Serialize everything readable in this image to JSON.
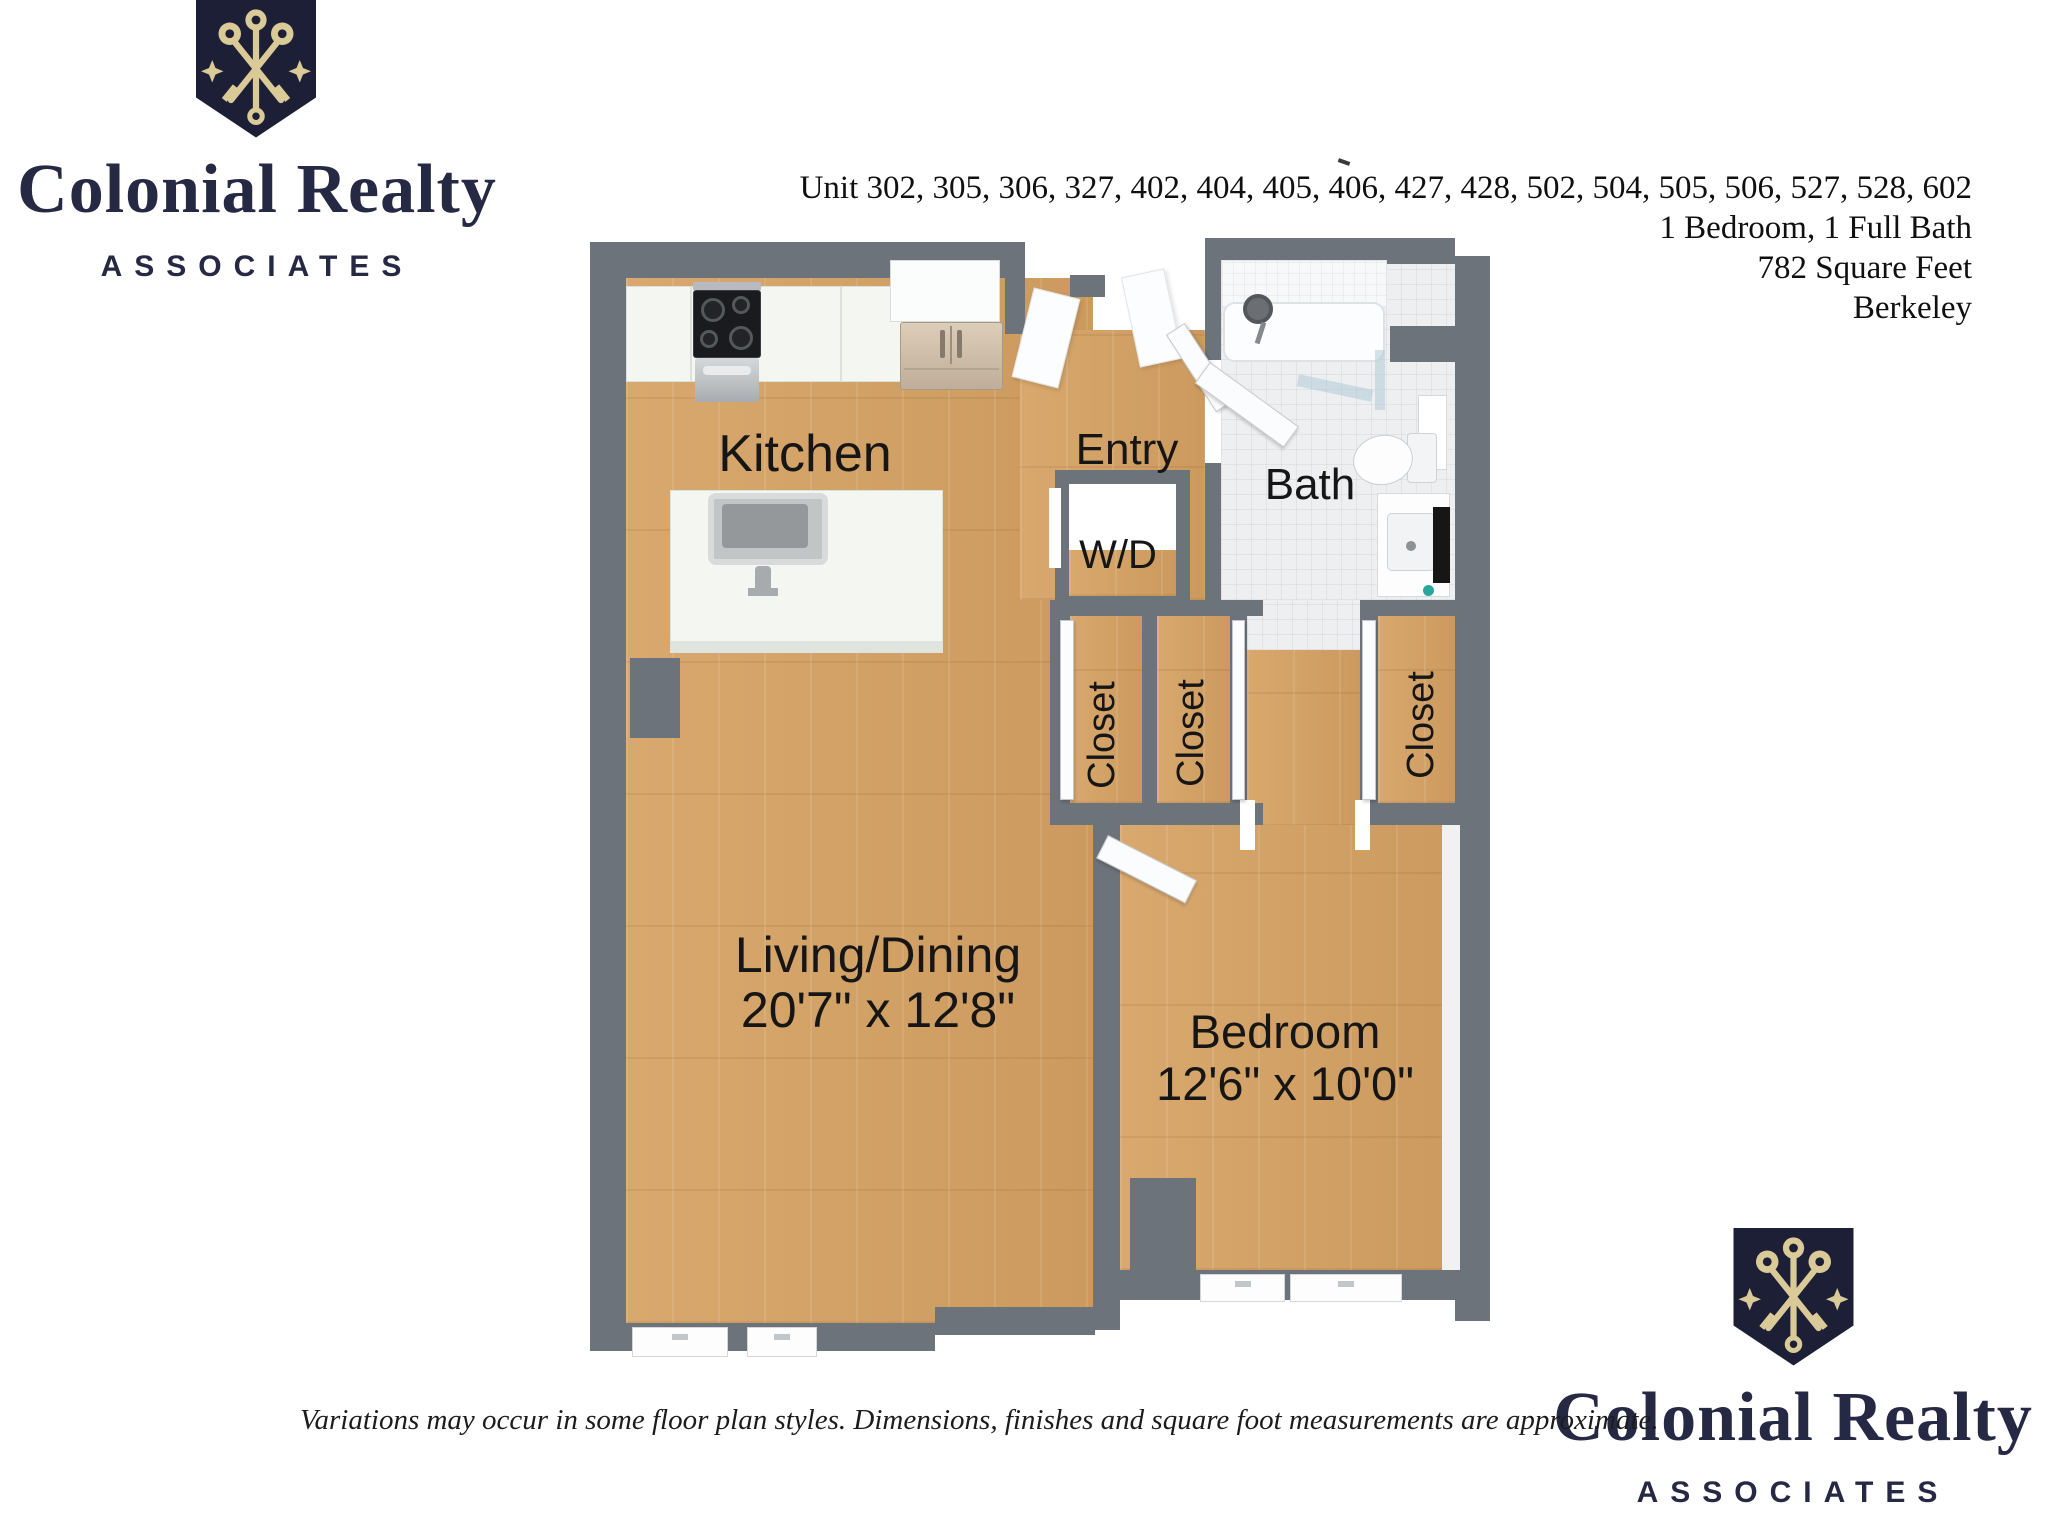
{
  "branding": {
    "name": "Colonial Realty",
    "subname": "ASSOCIATES",
    "shield_icon": "crossed-keys-shield-icon",
    "colors": {
      "navy": "#262943",
      "gold": "#d9ca98"
    }
  },
  "unit_info": {
    "units": "Unit 302, 305, 306, 327, 402, 404, 405, 406, 427, 428, 502, 504, 505, 506, 527, 528, 602",
    "bed_bath": "1 Bedroom, 1 Full Bath",
    "square_feet": "782 Square Feet",
    "city": "Berkeley"
  },
  "floor_plan": {
    "labels": {
      "kitchen": "Kitchen",
      "entry": "Entry",
      "bath": "Bath",
      "washer_dryer": "W/D",
      "closet_1": "Closet",
      "closet_2": "Closet",
      "closet_3": "Closet",
      "living_dining": "Living/Dining",
      "living_dining_dimensions": "20'7\" x 12'8\"",
      "bedroom": "Bedroom",
      "bedroom_dimensions": "12'6\" x 10'0\""
    },
    "colors": {
      "wall": "#6d737b",
      "wood_floor": "#d3a369",
      "tile_floor": "#edeff1"
    }
  },
  "disclaimer": "Variations may occur in some floor plan styles. Dimensions, finishes and square foot measurements are approximate."
}
